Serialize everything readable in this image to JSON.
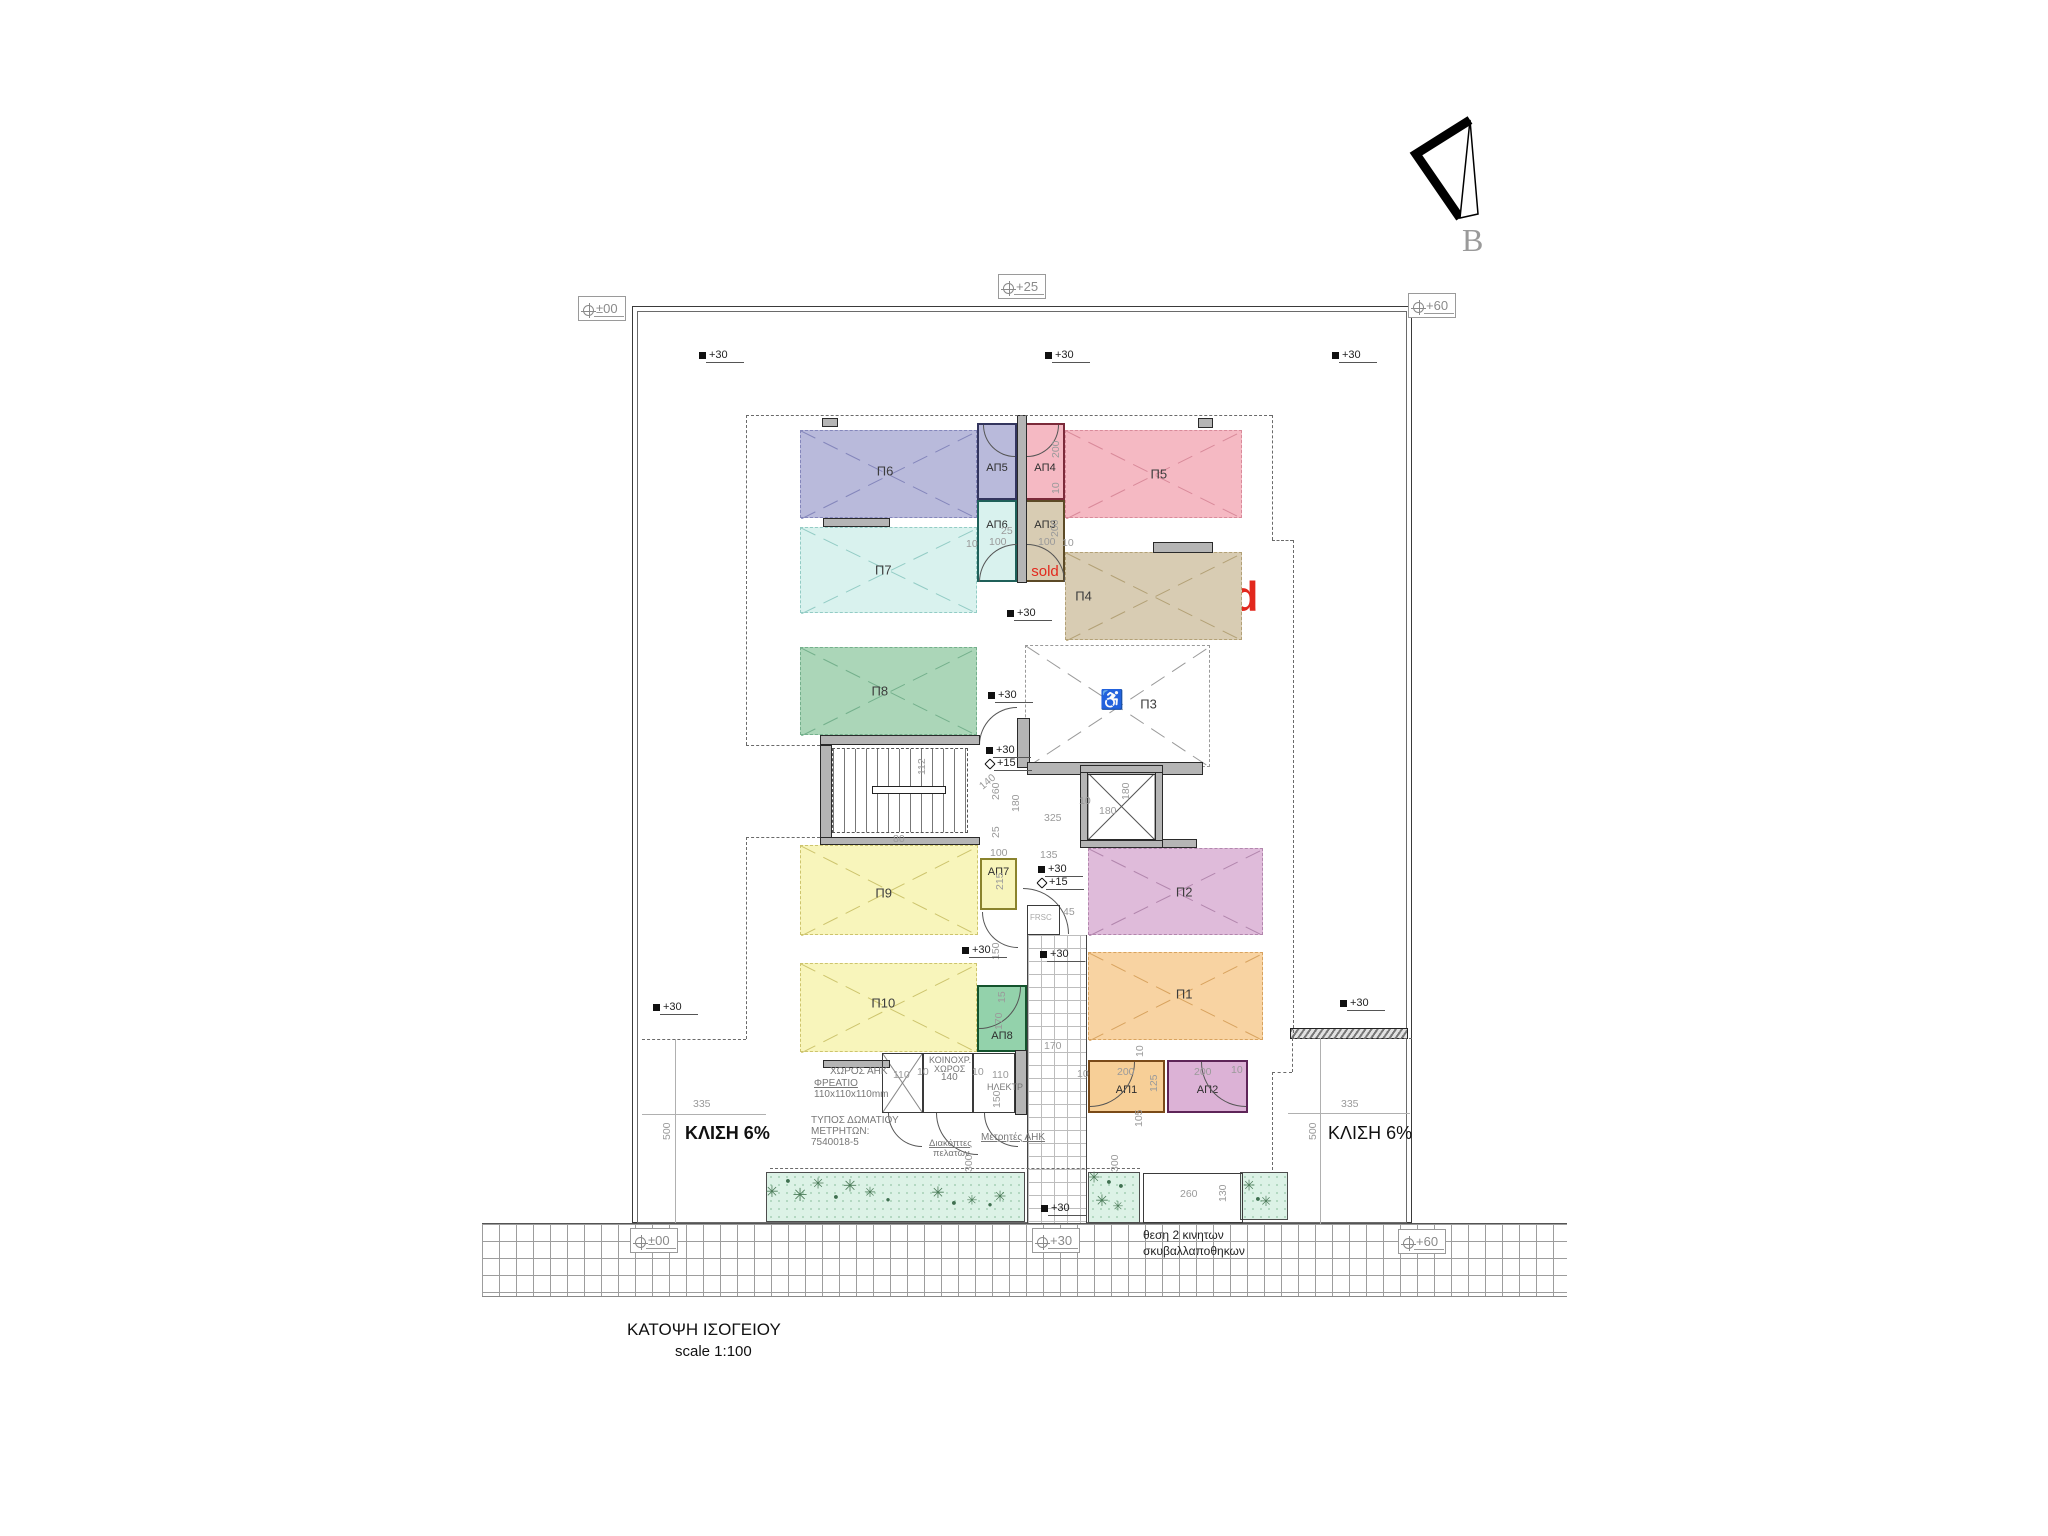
{
  "meta": {
    "title": "ΚΑΤΟΨΗ ΙΣΟΓΕΙΟΥ",
    "scale_label": "scale 1:100",
    "north_label": "B"
  },
  "colors": {
    "sold_red": "#e2281d",
    "dim_text": "#9a9a9a",
    "wall_gray": "#b5b5b5",
    "grass": "#dcf2e6"
  },
  "parking": [
    {
      "id": "P6",
      "label": "Π6",
      "x": 800,
      "y": 430,
      "w": 177,
      "h": 88,
      "fill": "#b9badb",
      "line": "#8486bb",
      "lfx": 0.48,
      "lfy": 0.47
    },
    {
      "id": "P5",
      "label": "Π5",
      "x": 1065,
      "y": 430,
      "w": 177,
      "h": 88,
      "fill": "#f5b9c3",
      "line": "#d98a9a",
      "lfx": 0.53,
      "lfy": 0.5
    },
    {
      "id": "P7",
      "label": "Π7",
      "x": 800,
      "y": 527,
      "w": 177,
      "h": 86,
      "fill": "#d9f2ee",
      "line": "#93ccc5",
      "lfx": 0.47,
      "lfy": 0.5
    },
    {
      "id": "P4",
      "label": "Π4",
      "x": 1065,
      "y": 552,
      "w": 177,
      "h": 88,
      "fill": "#d8ccb3",
      "line": "#b3a176",
      "lfx": 0.1,
      "lfy": 0.5,
      "sold": "sold"
    },
    {
      "id": "P8",
      "label": "Π8",
      "x": 800,
      "y": 647,
      "w": 177,
      "h": 88,
      "fill": "#abd6b8",
      "line": "#74b08c",
      "lfx": 0.45,
      "lfy": 0.5
    },
    {
      "id": "P3",
      "label": "Π3",
      "x": 1025,
      "y": 645,
      "w": 185,
      "h": 122,
      "fill": "#ffffff",
      "line": "#9a9a9a",
      "lfx": 0.67,
      "lfy": 0.48,
      "icon": "♿",
      "ifx": 0.47,
      "ify": 0.45
    },
    {
      "id": "P9",
      "label": "Π9",
      "x": 800,
      "y": 845,
      "w": 178,
      "h": 90,
      "fill": "#f8f5bb",
      "line": "#cdc46d",
      "lfx": 0.47,
      "lfy": 0.53
    },
    {
      "id": "P2",
      "label": "Π2",
      "x": 1088,
      "y": 848,
      "w": 175,
      "h": 87,
      "fill": "#dfbbda",
      "line": "#b286ad",
      "lfx": 0.55,
      "lfy": 0.5
    },
    {
      "id": "P10",
      "label": "Π10",
      "x": 800,
      "y": 963,
      "w": 177,
      "h": 89,
      "fill": "#f8f5bb",
      "line": "#cdc46d",
      "lfx": 0.47,
      "lfy": 0.45
    },
    {
      "id": "P1",
      "label": "Π1",
      "x": 1088,
      "y": 952,
      "w": 175,
      "h": 88,
      "fill": "#f8d3a2",
      "line": "#d8a35f",
      "lfx": 0.55,
      "lfy": 0.48
    }
  ],
  "storage": [
    {
      "id": "AP5",
      "label": "ΑΠ5",
      "x": 977,
      "y": 423,
      "w": 40,
      "h": 77,
      "fill": "#b9badb",
      "border": "#33355e",
      "door": "bl",
      "ly": 0.5
    },
    {
      "id": "AP4",
      "label": "ΑΠ4",
      "x": 1025,
      "y": 423,
      "w": 40,
      "h": 77,
      "fill": "#f5b9c3",
      "border": "#7b2a3a",
      "door": "br",
      "ly": 0.5
    },
    {
      "id": "AP6",
      "label": "ΑΠ6",
      "x": 977,
      "y": 500,
      "w": 40,
      "h": 82,
      "fill": "#d9f2ee",
      "border": "#1f6059",
      "door": null,
      "ly": 0.22
    },
    {
      "id": "AP3",
      "label": "ΑΠ3",
      "x": 1025,
      "y": 500,
      "w": 40,
      "h": 82,
      "fill": "#d8ccb3",
      "border": "#5c4a26",
      "door": null,
      "ly": 0.22,
      "sold": "sold"
    },
    {
      "id": "AP7",
      "label": "ΑΠ7",
      "x": 980,
      "y": 858,
      "w": 37,
      "h": 52,
      "fill": "#f8f5bb",
      "border": "#8a832d",
      "door": null,
      "ly": 0.12
    },
    {
      "id": "AP8",
      "label": "ΑΠ8",
      "x": 977,
      "y": 985,
      "w": 50,
      "h": 67,
      "fill": "#93d2ab",
      "border": "#14532d",
      "door": "br",
      "ly": 0.68
    },
    {
      "id": "AP1",
      "label": "ΑΠ1",
      "x": 1088,
      "y": 1060,
      "w": 77,
      "h": 53,
      "fill": "#f7cf97",
      "border": "#7a4a18",
      "door": "br",
      "ly": 0.45
    },
    {
      "id": "AP2",
      "label": "ΑΠ2",
      "x": 1167,
      "y": 1060,
      "w": 81,
      "h": 53,
      "fill": "#dcb2d6",
      "border": "#5e2558",
      "door": "bl",
      "ly": 0.45
    }
  ],
  "arcs": [
    {
      "x": 979,
      "y": 544,
      "r": 38,
      "c": "tl"
    },
    {
      "x": 1027,
      "y": 544,
      "r": 38,
      "c": "tr"
    },
    {
      "x": 979,
      "y": 707,
      "r": 38,
      "c": "tl"
    },
    {
      "x": 1023,
      "y": 888,
      "r": 46,
      "c": "tr"
    },
    {
      "x": 982,
      "y": 912,
      "r": 36,
      "c": "bl"
    },
    {
      "x": 888,
      "y": 1113,
      "r": 34,
      "c": "bl"
    },
    {
      "x": 936,
      "y": 1113,
      "r": 42,
      "c": "bl"
    },
    {
      "x": 984,
      "y": 1113,
      "r": 34,
      "c": "bl"
    }
  ],
  "boxed_markers": [
    {
      "label": "±00",
      "x": 578,
      "y": 296
    },
    {
      "label": "+25",
      "x": 998,
      "y": 274
    },
    {
      "label": "+60",
      "x": 1408,
      "y": 293
    },
    {
      "label": "±00",
      "x": 630,
      "y": 1228
    },
    {
      "label": "+30",
      "x": 1032,
      "y": 1228
    },
    {
      "label": "+60",
      "x": 1398,
      "y": 1229
    }
  ],
  "spot_markers": [
    {
      "label": "+30",
      "x": 699,
      "y": 349,
      "s": "f"
    },
    {
      "label": "+30",
      "x": 1045,
      "y": 349,
      "s": "f"
    },
    {
      "label": "+30",
      "x": 1332,
      "y": 349,
      "s": "f"
    },
    {
      "label": "+30",
      "x": 1007,
      "y": 607,
      "s": "f"
    },
    {
      "label": "+30",
      "x": 988,
      "y": 689,
      "s": "f"
    },
    {
      "label": "+30",
      "x": 986,
      "y": 744,
      "s": "f"
    },
    {
      "label": "+15",
      "x": 986,
      "y": 757,
      "s": "o"
    },
    {
      "label": "+30",
      "x": 1038,
      "y": 863,
      "s": "f"
    },
    {
      "label": "+15",
      "x": 1038,
      "y": 876,
      "s": "o"
    },
    {
      "label": "+30",
      "x": 962,
      "y": 944,
      "s": "f"
    },
    {
      "label": "+30",
      "x": 1040,
      "y": 948,
      "s": "f"
    },
    {
      "label": "+30",
      "x": 653,
      "y": 1001,
      "s": "f"
    },
    {
      "label": "+30",
      "x": 1340,
      "y": 997,
      "s": "f"
    },
    {
      "label": "+30",
      "x": 1041,
      "y": 1202,
      "s": "f"
    }
  ],
  "dims": [
    {
      "t": "200",
      "x": 1050,
      "y": 458,
      "rot": true
    },
    {
      "t": "10",
      "x": 1050,
      "y": 494,
      "rot": true
    },
    {
      "t": "200",
      "x": 1049,
      "y": 537,
      "rot": true
    },
    {
      "t": "25",
      "x": 1001,
      "y": 525
    },
    {
      "t": "10",
      "x": 966,
      "y": 538
    },
    {
      "t": "100",
      "x": 989,
      "y": 536
    },
    {
      "t": "100",
      "x": 1038,
      "y": 536
    },
    {
      "t": "10",
      "x": 1062,
      "y": 537
    },
    {
      "t": "112",
      "x": 916,
      "y": 775,
      "rot": true
    },
    {
      "t": "80",
      "x": 893,
      "y": 833
    },
    {
      "t": "140",
      "x": 977,
      "y": 783,
      "rot45": true
    },
    {
      "t": "260",
      "x": 990,
      "y": 800,
      "rot": true
    },
    {
      "t": "180",
      "x": 1010,
      "y": 812,
      "rot": true
    },
    {
      "t": "325",
      "x": 1044,
      "y": 812
    },
    {
      "t": "10",
      "x": 1079,
      "y": 795
    },
    {
      "t": "180",
      "x": 1099,
      "y": 805
    },
    {
      "t": "180",
      "x": 1120,
      "y": 800,
      "rot": true
    },
    {
      "t": "25",
      "x": 990,
      "y": 838,
      "rot": true
    },
    {
      "t": "100",
      "x": 990,
      "y": 847
    },
    {
      "t": "135",
      "x": 1040,
      "y": 849
    },
    {
      "t": "215",
      "x": 994,
      "y": 890,
      "rot": true
    },
    {
      "t": "45",
      "x": 1063,
      "y": 906
    },
    {
      "t": "150",
      "x": 990,
      "y": 960,
      "rot": true
    },
    {
      "t": "15",
      "x": 996,
      "y": 1003,
      "rot": true
    },
    {
      "t": "170",
      "x": 993,
      "y": 1030,
      "rot": true
    },
    {
      "t": "170",
      "x": 1044,
      "y": 1040
    },
    {
      "t": "110",
      "x": 893,
      "y": 1069
    },
    {
      "t": "10",
      "x": 917,
      "y": 1066
    },
    {
      "t": "10",
      "x": 972,
      "y": 1066
    },
    {
      "t": "110",
      "x": 992,
      "y": 1069
    },
    {
      "t": "150",
      "x": 991,
      "y": 1108,
      "rot": true
    },
    {
      "t": "10",
      "x": 1077,
      "y": 1068
    },
    {
      "t": "200",
      "x": 1117,
      "y": 1066
    },
    {
      "t": "125",
      "x": 1148,
      "y": 1092,
      "rot": true
    },
    {
      "t": "200",
      "x": 1194,
      "y": 1066
    },
    {
      "t": "10",
      "x": 1231,
      "y": 1064
    },
    {
      "t": "10",
      "x": 1134,
      "y": 1057,
      "rot": true
    },
    {
      "t": "105",
      "x": 1133,
      "y": 1127,
      "rot": true
    },
    {
      "t": "300",
      "x": 963,
      "y": 1172,
      "rot": true
    },
    {
      "t": "300",
      "x": 1109,
      "y": 1172,
      "rot": true
    },
    {
      "t": "260",
      "x": 1180,
      "y": 1188
    },
    {
      "t": "130",
      "x": 1217,
      "y": 1202,
      "rot": true
    },
    {
      "t": "335",
      "x": 693,
      "y": 1098
    },
    {
      "t": "500",
      "x": 661,
      "y": 1140,
      "rot": true
    },
    {
      "t": "335",
      "x": 1341,
      "y": 1098
    },
    {
      "t": "500",
      "x": 1307,
      "y": 1140,
      "rot": true
    }
  ],
  "texts": [
    {
      "t": "ΚΛΙΣΗ 6%",
      "x": 685,
      "y": 1123,
      "fs": 18,
      "c": "#111",
      "b": true
    },
    {
      "t": "ΚΛΙΣΗ 6%",
      "x": 1328,
      "y": 1123,
      "fs": 18,
      "c": "#111",
      "b": false
    },
    {
      "t": "θεση 2 κινητων",
      "x": 1143,
      "y": 1228,
      "fs": 12,
      "c": "#222"
    },
    {
      "t": "σκυβαλλαποθηκων",
      "x": 1143,
      "y": 1244,
      "fs": 12,
      "c": "#222"
    },
    {
      "t": "ΧΩΡΟΣ  ΑΗΚ",
      "x": 830,
      "y": 1066,
      "fs": 10,
      "c": "#777"
    },
    {
      "t": "ΦΡΕΑΤΙΟ",
      "x": 814,
      "y": 1078,
      "fs": 10,
      "c": "#777",
      "u": true
    },
    {
      "t": "110x110x110mm",
      "x": 814,
      "y": 1089,
      "fs": 10,
      "c": "#777"
    },
    {
      "t": "ΤΥΠΟΣ ΔΩΜΑΤΙΟΥ",
      "x": 811,
      "y": 1115,
      "fs": 10,
      "c": "#777"
    },
    {
      "t": "ΜΕΤΡΗΤΩΝ:",
      "x": 811,
      "y": 1126,
      "fs": 10,
      "c": "#777"
    },
    {
      "t": "7540018-5",
      "x": 811,
      "y": 1137,
      "fs": 10,
      "c": "#777"
    },
    {
      "t": "ΚΟΙΝΟΧΡ.",
      "x": 929,
      "y": 1055,
      "fs": 9,
      "c": "#777"
    },
    {
      "t": "ΧΩΡΟΣ",
      "x": 934,
      "y": 1064,
      "fs": 9,
      "c": "#777"
    },
    {
      "t": "140",
      "x": 941,
      "y": 1072,
      "fs": 10,
      "c": "#777"
    },
    {
      "t": "ΗΛΕΚΤΡ",
      "x": 987,
      "y": 1082,
      "fs": 9,
      "c": "#777"
    },
    {
      "t": "Μετρητές  ΑΗΚ",
      "x": 981,
      "y": 1132,
      "fs": 10,
      "c": "#777",
      "u": true
    },
    {
      "t": "Διακόπτες",
      "x": 929,
      "y": 1138,
      "fs": 9.5,
      "c": "#777",
      "u": true
    },
    {
      "t": "πελατων",
      "x": 933,
      "y": 1148,
      "fs": 9.5,
      "c": "#777"
    },
    {
      "t": "FRSC",
      "x": 1030,
      "y": 913,
      "fs": 8,
      "c": "#aaa"
    }
  ],
  "walls": [
    {
      "x": 822,
      "y": 418,
      "w": 16,
      "h": 9
    },
    {
      "x": 1198,
      "y": 418,
      "w": 15,
      "h": 10
    },
    {
      "x": 1017,
      "y": 415,
      "w": 10,
      "h": 168
    },
    {
      "x": 823,
      "y": 518,
      "w": 67,
      "h": 9
    },
    {
      "x": 1153,
      "y": 542,
      "w": 60,
      "h": 11
    },
    {
      "x": 820,
      "y": 735,
      "w": 160,
      "h": 10
    },
    {
      "x": 820,
      "y": 745,
      "w": 12,
      "h": 98
    },
    {
      "x": 820,
      "y": 837,
      "w": 160,
      "h": 8
    },
    {
      "x": 1017,
      "y": 718,
      "w": 13,
      "h": 50
    },
    {
      "x": 1027,
      "y": 762,
      "w": 176,
      "h": 13
    },
    {
      "x": 1080,
      "y": 839,
      "w": 117,
      "h": 9
    },
    {
      "x": 1080,
      "y": 765,
      "w": 8,
      "h": 83
    },
    {
      "x": 1155,
      "y": 765,
      "w": 8,
      "h": 83
    },
    {
      "x": 1080,
      "y": 765,
      "w": 83,
      "h": 8
    },
    {
      "x": 1080,
      "y": 840,
      "w": 83,
      "h": 8
    },
    {
      "x": 1015,
      "y": 1050,
      "w": 12,
      "h": 65
    },
    {
      "x": 823,
      "y": 1060,
      "w": 67,
      "h": 8
    }
  ],
  "hatch_walls": [
    {
      "x": 1290,
      "y": 1028,
      "w": 118,
      "h": 11
    }
  ],
  "thin_rects": [
    {
      "x": 882,
      "y": 1053,
      "w": 41,
      "h": 60
    },
    {
      "x": 923,
      "y": 1053,
      "w": 50,
      "h": 60
    },
    {
      "x": 973,
      "y": 1053,
      "w": 42,
      "h": 60
    },
    {
      "x": 1143,
      "y": 1173,
      "w": 100,
      "h": 50
    },
    {
      "x": 1027,
      "y": 905,
      "w": 33,
      "h": 30
    }
  ],
  "dash_segments": [
    {
      "o": "h",
      "x": 746,
      "y": 415,
      "len": 526
    },
    {
      "o": "v",
      "x": 746,
      "y": 415,
      "len": 330
    },
    {
      "o": "h",
      "x": 746,
      "y": 745,
      "len": 74
    },
    {
      "o": "h",
      "x": 746,
      "y": 837,
      "len": 74
    },
    {
      "o": "v",
      "x": 746,
      "y": 837,
      "len": 202
    },
    {
      "o": "v",
      "x": 1272,
      "y": 415,
      "len": 125
    },
    {
      "o": "h",
      "x": 1272,
      "y": 540,
      "len": 21
    },
    {
      "o": "v",
      "x": 1293,
      "y": 540,
      "len": 498
    },
    {
      "o": "h",
      "x": 642,
      "y": 1039,
      "len": 104
    },
    {
      "o": "h",
      "x": 1292,
      "y": 1038,
      "len": 120
    },
    {
      "o": "v",
      "x": 1292,
      "y": 1038,
      "len": 34
    },
    {
      "o": "h",
      "x": 1272,
      "y": 1072,
      "len": 20
    },
    {
      "o": "v",
      "x": 1272,
      "y": 1072,
      "len": 98
    },
    {
      "o": "h",
      "x": 770,
      "y": 1168,
      "len": 370
    }
  ],
  "dim_lines": [
    {
      "o": "h",
      "x": 642,
      "y": 1114,
      "len": 124
    },
    {
      "o": "h",
      "x": 1288,
      "y": 1113,
      "len": 122
    },
    {
      "o": "v",
      "x": 675,
      "y": 1039,
      "len": 184
    },
    {
      "o": "v",
      "x": 1320,
      "y": 1038,
      "len": 186
    }
  ],
  "plants": [
    {
      "x": 772,
      "y": 1193,
      "k": "s",
      "sz": 16
    },
    {
      "x": 788,
      "y": 1181,
      "k": "d",
      "sz": 9
    },
    {
      "x": 800,
      "y": 1195,
      "k": "s",
      "sz": 18
    },
    {
      "x": 818,
      "y": 1184,
      "k": "s",
      "sz": 15
    },
    {
      "x": 836,
      "y": 1197,
      "k": "d",
      "sz": 9
    },
    {
      "x": 850,
      "y": 1186,
      "k": "s",
      "sz": 17
    },
    {
      "x": 870,
      "y": 1192,
      "k": "s",
      "sz": 14
    },
    {
      "x": 888,
      "y": 1200,
      "k": "d",
      "sz": 8
    },
    {
      "x": 938,
      "y": 1194,
      "k": "s",
      "sz": 16
    },
    {
      "x": 954,
      "y": 1203,
      "k": "d",
      "sz": 9
    },
    {
      "x": 972,
      "y": 1200,
      "k": "s",
      "sz": 13
    },
    {
      "x": 1000,
      "y": 1197,
      "k": "s",
      "sz": 15
    },
    {
      "x": 990,
      "y": 1205,
      "k": "d",
      "sz": 8
    },
    {
      "x": 1094,
      "y": 1178,
      "k": "s",
      "sz": 15
    },
    {
      "x": 1109,
      "y": 1182,
      "k": "d",
      "sz": 9
    },
    {
      "x": 1121,
      "y": 1186,
      "k": "d",
      "sz": 9
    },
    {
      "x": 1102,
      "y": 1202,
      "k": "s",
      "sz": 16
    },
    {
      "x": 1118,
      "y": 1206,
      "k": "s",
      "sz": 13
    },
    {
      "x": 1249,
      "y": 1186,
      "k": "s",
      "sz": 15
    },
    {
      "x": 1258,
      "y": 1199,
      "k": "d",
      "sz": 9
    },
    {
      "x": 1266,
      "y": 1201,
      "k": "s",
      "sz": 14
    }
  ],
  "sold_big": {
    "t": "sold",
    "x": 1172,
    "y": 573,
    "fs": 42
  },
  "sold_small_ap3": "sold",
  "wheelchair_icon": "♿"
}
